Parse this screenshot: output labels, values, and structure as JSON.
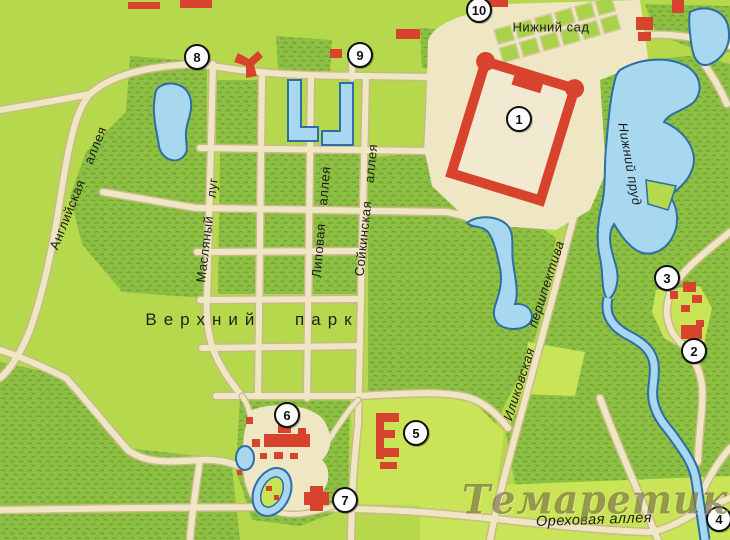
{
  "labels": {
    "nizhny_sad": "Нижний сад",
    "nizhny_prud": "Нижний пруд",
    "angliyskaya": "Английская аллея",
    "maslyany": "Масляный луг",
    "lipovaya": "Липовая аллея",
    "soykinskaya": "Сойкинская аллея",
    "verkhny_park": "Верхний парк",
    "ilikovskaya": "Иликовская",
    "pershpektiva": "першпектива",
    "orekhovaya": "Ореховая аллея"
  },
  "markers": [
    {
      "number": "1"
    },
    {
      "number": "2"
    },
    {
      "number": "3"
    },
    {
      "number": "4"
    },
    {
      "number": "5"
    },
    {
      "number": "6"
    },
    {
      "number": "7"
    },
    {
      "number": "8"
    },
    {
      "number": "9"
    },
    {
      "number": "10"
    }
  ],
  "watermark": "Темаретик.СОМ",
  "colors": {
    "meadow": "#b5d84c",
    "bright_meadow": "#c9e456",
    "forest": "#8cbf42",
    "road": "#efe7c3",
    "road_edge": "#c9b98b",
    "water": "#a8d8ef",
    "water_outline": "#2d6ea5",
    "building": "#d8432e",
    "marker_bg": "#ffffff",
    "marker_border": "#111111"
  }
}
